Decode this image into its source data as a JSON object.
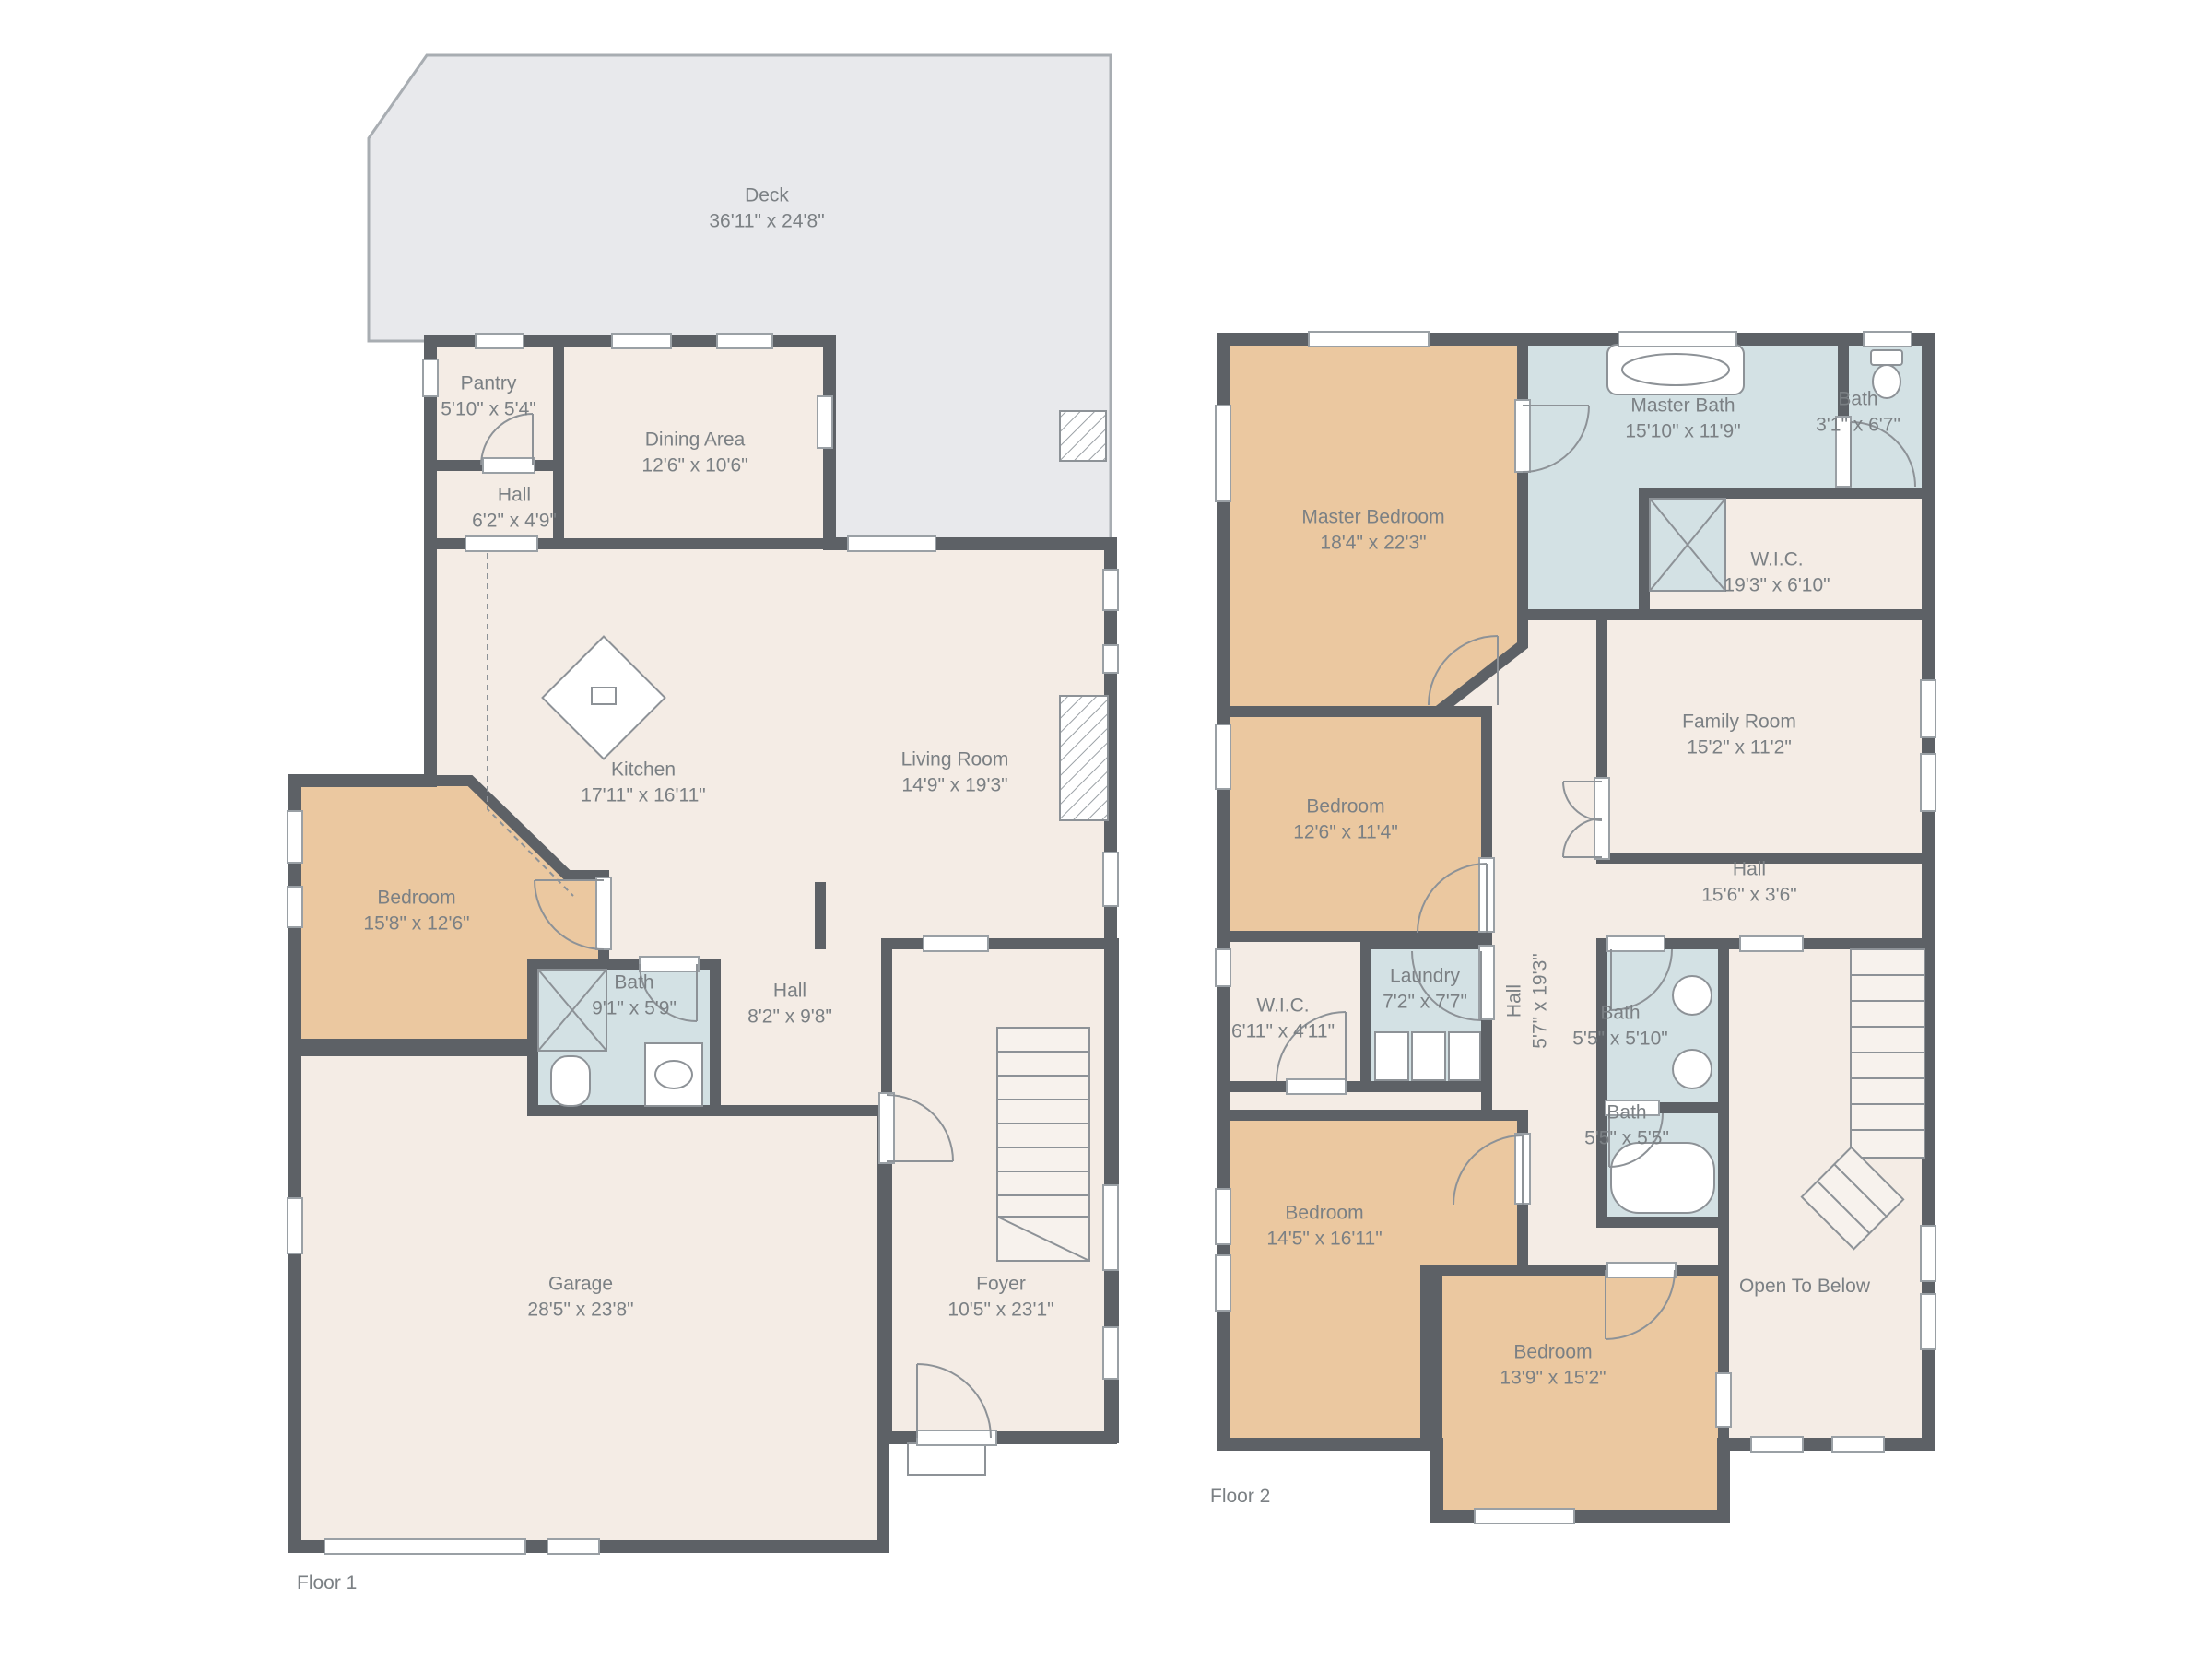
{
  "colors": {
    "wall": "#5d6166",
    "floor": "#f4ece5",
    "bedroom": "#ebc8a0",
    "bath": "#d3e1e4",
    "deck": "#e8e9ec",
    "label": "#7b8084"
  },
  "floor1": {
    "label": "Floor 1",
    "rooms": {
      "deck": {
        "name": "Deck",
        "dims": "36'11\" x 24'8\""
      },
      "pantry": {
        "name": "Pantry",
        "dims": "5'10\" x 5'4\""
      },
      "dining": {
        "name": "Dining Area",
        "dims": "12'6\" x 10'6\""
      },
      "hall_upper": {
        "name": "Hall",
        "dims": "6'2\" x 4'9\""
      },
      "kitchen": {
        "name": "Kitchen",
        "dims": "17'11\" x 16'11\""
      },
      "living": {
        "name": "Living Room",
        "dims": "14'9\" x 19'3\""
      },
      "bedroom": {
        "name": "Bedroom",
        "dims": "15'8\" x 12'6\""
      },
      "bath": {
        "name": "Bath",
        "dims": "9'1\" x 5'9\""
      },
      "hall_lower": {
        "name": "Hall",
        "dims": "8'2\" x 9'8\""
      },
      "garage": {
        "name": "Garage",
        "dims": "28'5\" x 23'8\""
      },
      "foyer": {
        "name": "Foyer",
        "dims": "10'5\" x 23'1\""
      }
    }
  },
  "floor2": {
    "label": "Floor 2",
    "rooms": {
      "master_bedroom": {
        "name": "Master Bedroom",
        "dims": "18'4\" x 22'3\""
      },
      "master_bath": {
        "name": "Master Bath",
        "dims": "15'10\" x 11'9\""
      },
      "bath_small": {
        "name": "Bath",
        "dims": "3'1\" x 6'7\""
      },
      "wic_large": {
        "name": "W.I.C.",
        "dims": "19'3\" x 6'10\""
      },
      "family_room": {
        "name": "Family Room",
        "dims": "15'2\" x 11'2\""
      },
      "bedroom_2": {
        "name": "Bedroom",
        "dims": "12'6\" x 11'4\""
      },
      "hall_main": {
        "name": "Hall",
        "dims": "15'6\" x 3'6\""
      },
      "hall_vertical": {
        "name": "Hall",
        "dims": "5'7\" x 19'3\""
      },
      "laundry": {
        "name": "Laundry",
        "dims": "7'2\" x 7'7\""
      },
      "wic_small": {
        "name": "W.I.C.",
        "dims": "6'11\" x 4'11\""
      },
      "bath_upper": {
        "name": "Bath",
        "dims": "5'5\" x 5'10\""
      },
      "bath_lower": {
        "name": "Bath",
        "dims": "5'5\" x 5'5\""
      },
      "bedroom_3": {
        "name": "Bedroom",
        "dims": "14'5\" x 16'11\""
      },
      "bedroom_4": {
        "name": "Bedroom",
        "dims": "13'9\" x 15'2\""
      },
      "open_below": {
        "name": "Open To Below"
      }
    }
  }
}
